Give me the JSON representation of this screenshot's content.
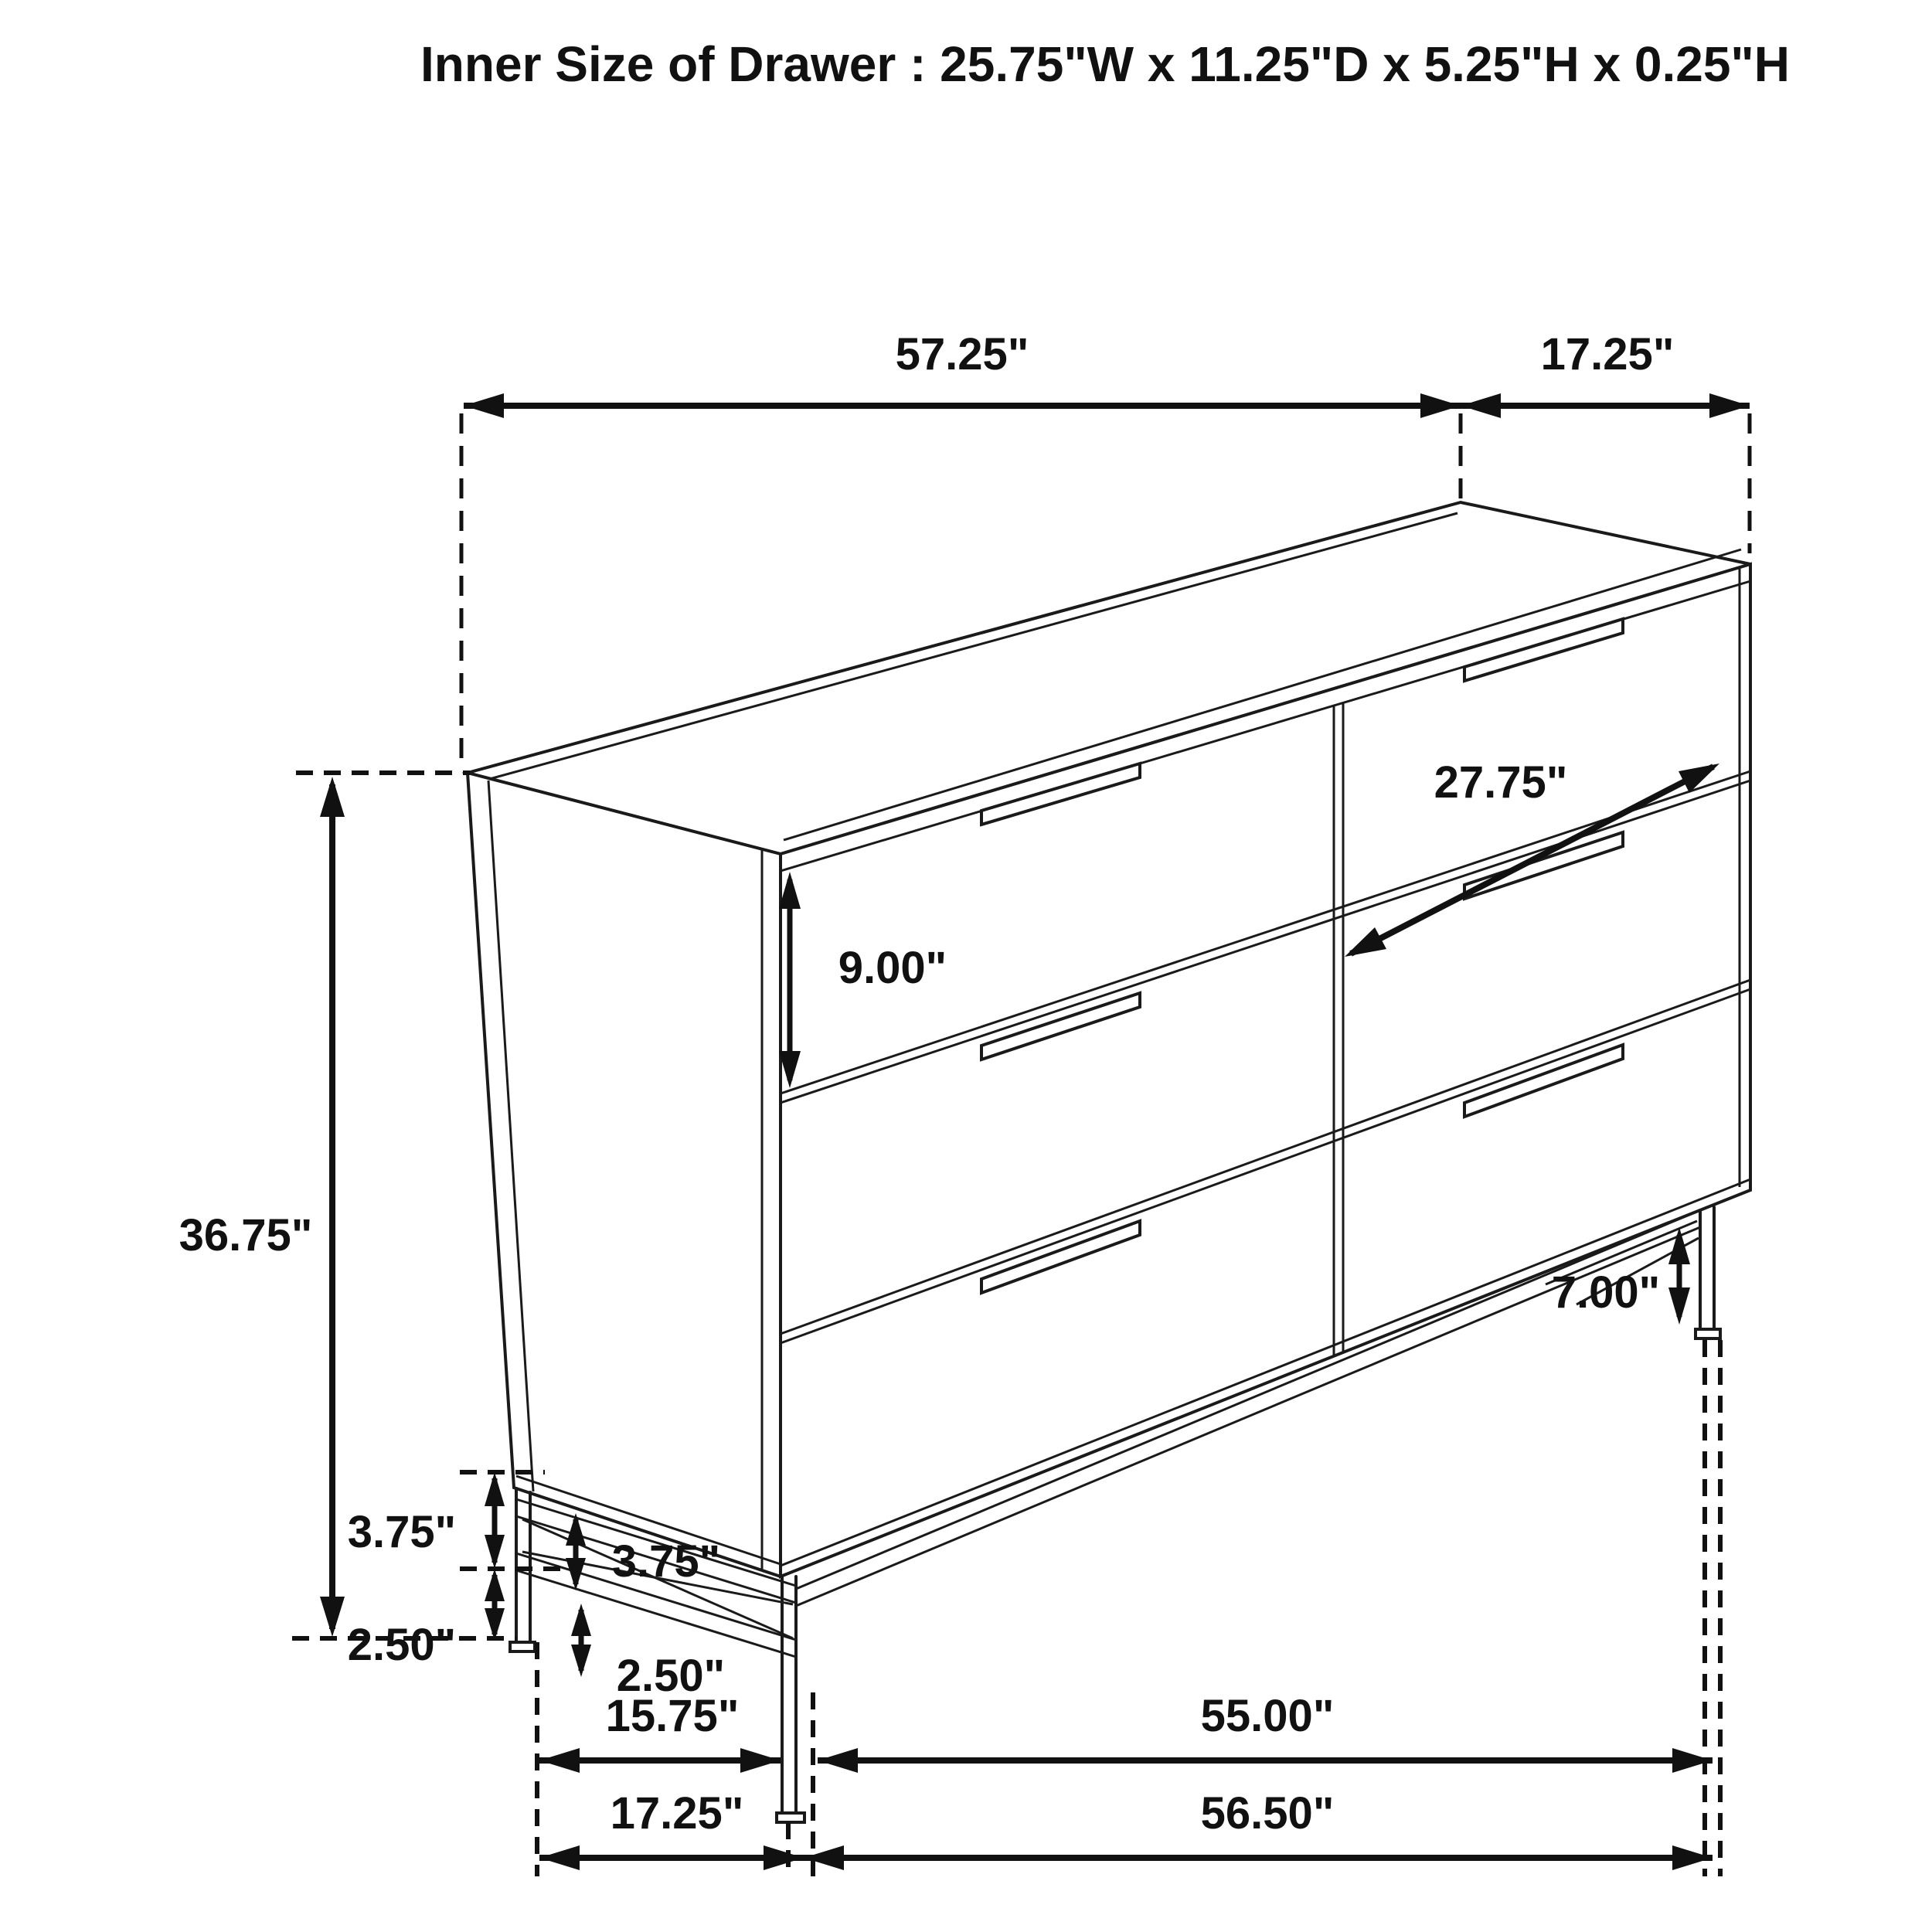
{
  "title": "Inner Size of Drawer : 25.75\"W x 11.25\"D x 5.25\"H x 0.25\"H",
  "colors": {
    "line": "#1a1a1a",
    "dimension": "#111111",
    "background": "#ffffff"
  },
  "dimensions": {
    "top_width": "57.25\"",
    "top_depth": "17.25\"",
    "drawer_diagonal_width": "27.75\"",
    "drawer_front_height": "9.00\"",
    "overall_height": "36.75\"",
    "base_frame_upper_outer": "3.75\"",
    "base_frame_upper_inner": "3.75\"",
    "base_frame_lower_outer": "2.50\"",
    "base_frame_lower_inner": "2.50\"",
    "leg_height": "7.00\"",
    "floor_span_left_inner": "15.75\"",
    "floor_span_right_inner": "55.00\"",
    "floor_span_left_outer": "17.25\"",
    "floor_span_right_outer": "56.50\""
  }
}
